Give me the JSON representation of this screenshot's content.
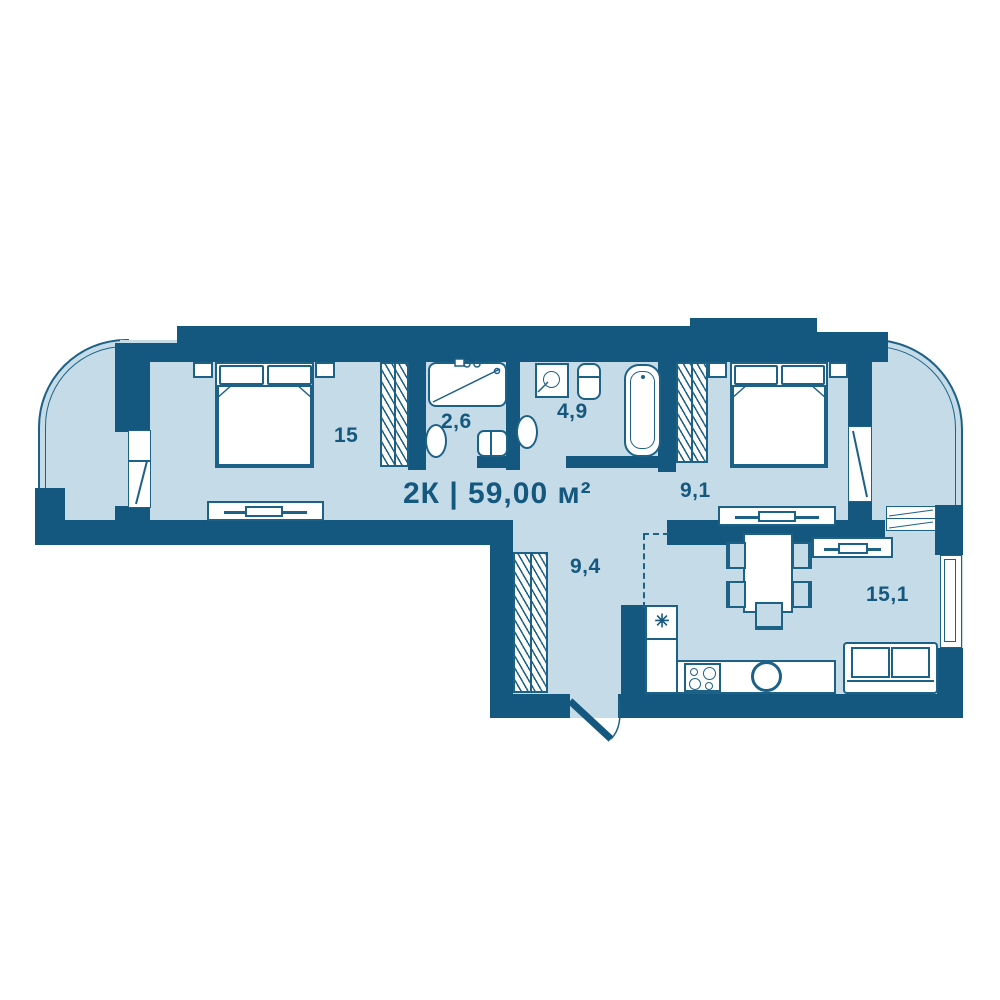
{
  "title": "2К | 59,00 м²",
  "rooms": {
    "bedroom1": {
      "area": "15"
    },
    "shower_room": {
      "area": "2,6"
    },
    "bathroom": {
      "area": "4,9"
    },
    "bedroom2": {
      "area": "9,1"
    },
    "hallway": {
      "area": "9,4"
    },
    "kitchen_living": {
      "area": "15,1"
    }
  },
  "icons": {
    "vent": "✳"
  },
  "colors": {
    "wall": "#15587f",
    "floor": "#c5dbe7",
    "line": "#1d6187",
    "white": "#ffffff",
    "bg": "#ffffff"
  }
}
